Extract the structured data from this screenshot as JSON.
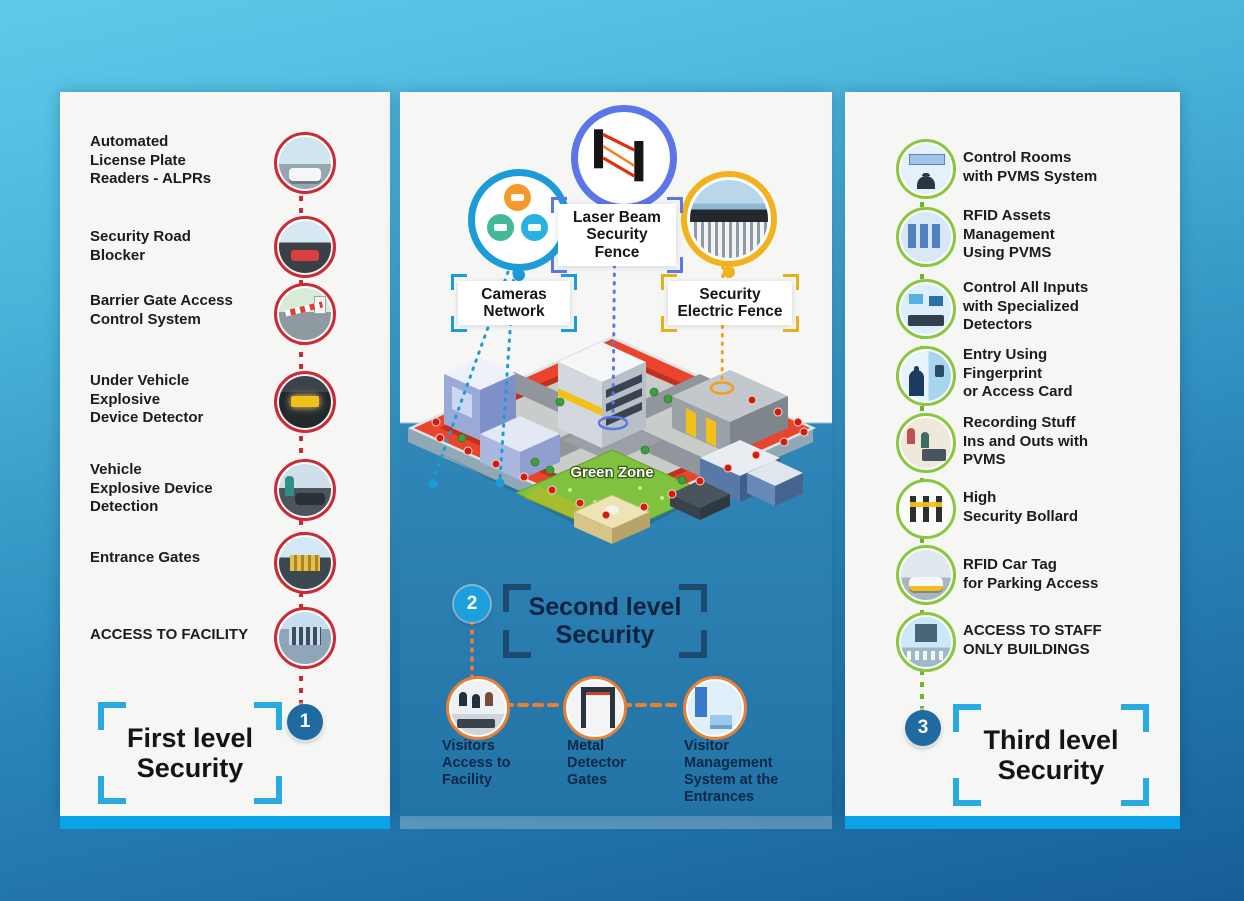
{
  "colors": {
    "accent_blue": "#29abe2",
    "red": "#cc2a36",
    "green": "#8cc63f",
    "orange": "#e87f35",
    "indigo": "#5b76e8",
    "yellow": "#f2b21d",
    "badge_dark": "#1e6aa1",
    "badge_light": "#1aa0dc"
  },
  "left_panel": {
    "badge": "1",
    "title": "First level\nSecurity",
    "items": [
      {
        "icon": "alpr-photo-icon",
        "label": "Automated\nLicense Plate\nReaders - ALPRs"
      },
      {
        "icon": "road-blocker-photo-icon",
        "label": "Security Road\nBlocker"
      },
      {
        "icon": "barrier-gate-photo-icon",
        "label": "Barrier Gate Access\nControl System"
      },
      {
        "icon": "under-vehicle-detector-photo-icon",
        "label": "Under Vehicle\nExplosive\nDevice Detector"
      },
      {
        "icon": "vehicle-explosive-photo-icon",
        "label": "Vehicle\nExplosive Device\nDetection"
      },
      {
        "icon": "entrance-gates-photo-icon",
        "label": "Entrance Gates"
      },
      {
        "icon": "access-facility-photo-icon",
        "label": "ACCESS TO FACILITY"
      }
    ]
  },
  "middle_panel": {
    "badge": "2",
    "title": "Second level\nSecurity",
    "green_zone_label": "Green Zone",
    "callouts": [
      {
        "icon": "cameras-network-icon",
        "label": "Cameras\nNetwork"
      },
      {
        "icon": "laser-beam-icon",
        "label": "Laser Beam\nSecurity\nFence"
      },
      {
        "icon": "electric-fence-icon",
        "label": "Security\nElectric Fence"
      }
    ],
    "bottom_items": [
      {
        "icon": "visitors-access-icon",
        "label": "Visitors\nAccess to\nFacility"
      },
      {
        "icon": "metal-detector-icon",
        "label": "Metal\nDetector\nGates"
      },
      {
        "icon": "visitor-management-icon",
        "label": "Visitor\nManagement\nSystem at the\nEntrances"
      }
    ]
  },
  "right_panel": {
    "badge": "3",
    "title": "Third level\nSecurity",
    "items": [
      {
        "icon": "control-rooms-icon",
        "label": "Control Rooms\nwith PVMS System"
      },
      {
        "icon": "rfid-assets-icon",
        "label": "RFID Assets\nManagement\nUsing PVMS"
      },
      {
        "icon": "control-inputs-icon",
        "label": "Control All Inputs\nwith Specialized\nDetectors"
      },
      {
        "icon": "fingerprint-entry-icon",
        "label": "Entry Using\nFingerprint\nor Access Card"
      },
      {
        "icon": "recording-staff-icon",
        "label": "Recording Stuff\nIns and Outs with\nPVMS"
      },
      {
        "icon": "security-bollard-icon",
        "label": "High\nSecurity Bollard"
      },
      {
        "icon": "rfid-car-tag-icon",
        "label": "RFID Car Tag\nfor Parking Access"
      },
      {
        "icon": "access-staff-buildings-icon",
        "label": "ACCESS TO STAFF\nONLY BUILDINGS"
      }
    ]
  }
}
